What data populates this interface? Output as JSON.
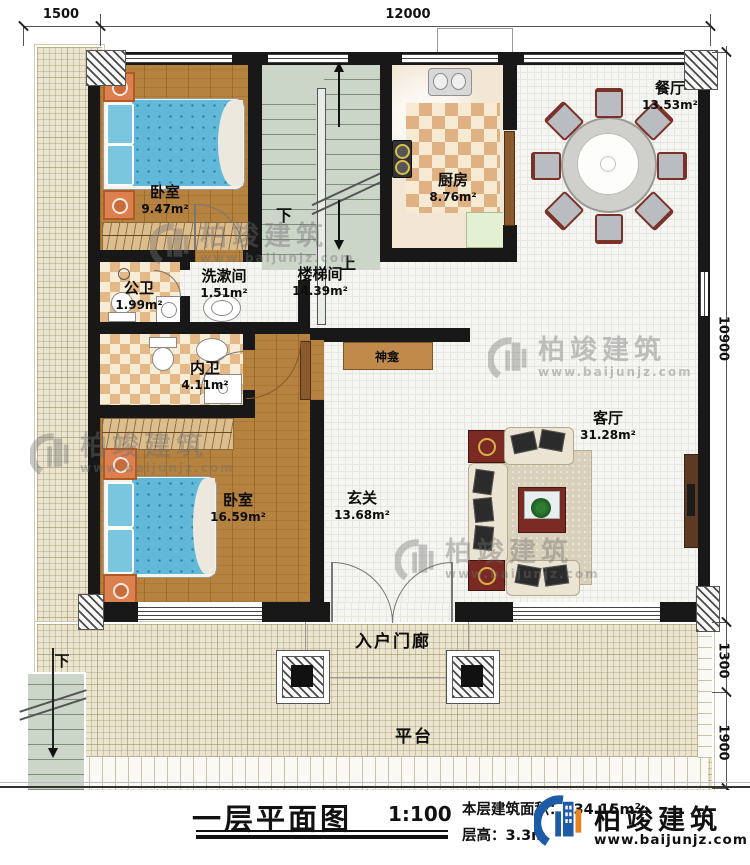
{
  "dims": {
    "top": [
      "1500",
      "12000"
    ],
    "right": [
      "10900",
      "1300",
      "1900"
    ]
  },
  "rooms": [
    {
      "name": "卧室",
      "area": "9.47m²"
    },
    {
      "name": "公卫",
      "area": "1.99m²"
    },
    {
      "name": "洗漱间",
      "area": "1.51m²"
    },
    {
      "name": "楼梯间",
      "area": "14.39m²"
    },
    {
      "name": "厨房",
      "area": "8.76m²"
    },
    {
      "name": "餐厅",
      "area": "13.53m²"
    },
    {
      "name": "内卫",
      "area": "4.11m²"
    },
    {
      "name": "卧室",
      "area": "16.59m²"
    },
    {
      "name": "玄关",
      "area": "13.68m²"
    },
    {
      "name": "客厅",
      "area": "31.28m²"
    },
    {
      "name": "神龛"
    },
    {
      "name": "入户门廊"
    },
    {
      "name": "平台"
    }
  ],
  "stairs": {
    "down": "下",
    "up": "上",
    "outdoor_down": "下"
  },
  "title_block": {
    "title": "一层平面图",
    "scale": "1:100",
    "floor_area_label": "本层建筑面积：",
    "floor_area_value": "134.15m²",
    "floor_height_label": "层高：",
    "floor_height_value": "3.3m"
  },
  "brand": {
    "name": "柏竣建筑",
    "url": "www.baijunjz.com",
    "logo_blue": "#1d5ba6",
    "logo_orange": "#e8821e"
  },
  "colors": {
    "wall": "#181818",
    "wood": "#b5823f",
    "tile": "#f5f5f2",
    "checker": "#e0b183",
    "platform": "#ebe5cf",
    "stair": "#cbd5c8",
    "bed": "#62b8d8",
    "accent_red": "#7a2a22"
  }
}
